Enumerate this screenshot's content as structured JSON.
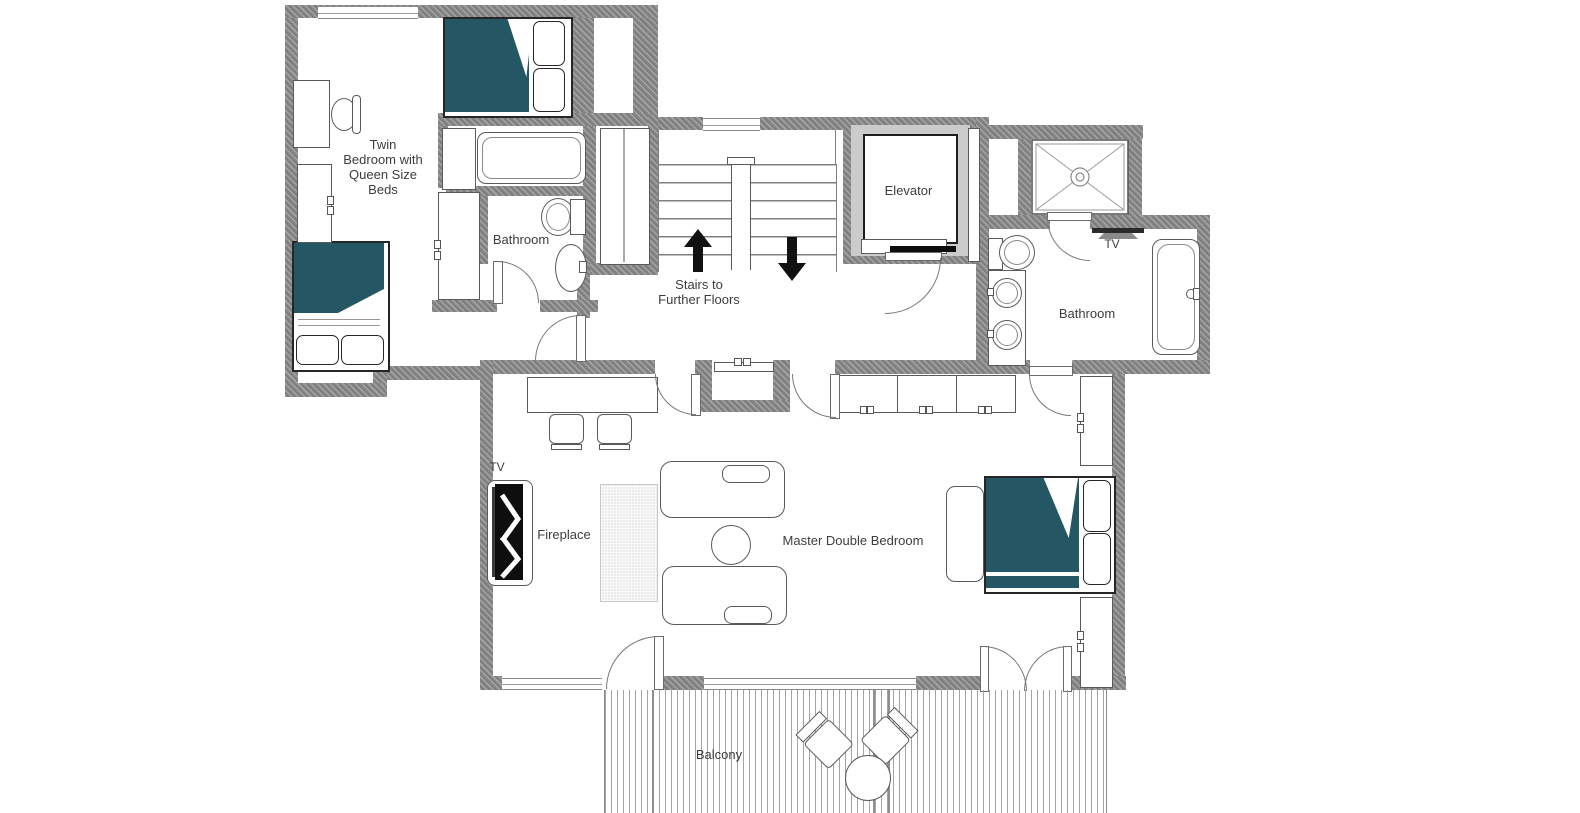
{
  "colors": {
    "wall": "#858585",
    "bed_teal": "#245763",
    "elevator_shaft": "#cbcbcb",
    "outline": "#5a5a5a"
  },
  "rooms": {
    "twin_bedroom": {
      "label_lines": [
        "Twin",
        "Bedroom with",
        "Queen Size",
        "Beds"
      ]
    },
    "bathroom_upper": {
      "label": "Bathroom"
    },
    "stairwell": {
      "label_lines": [
        "Stairs to",
        "Further Floors"
      ]
    },
    "elevator": {
      "label": "Elevator"
    },
    "ensuite_bathroom": {
      "label": "Bathroom",
      "tv_label": "TV"
    },
    "master_bedroom": {
      "label": "Master Double Bedroom",
      "fireplace_label": "Fireplace",
      "tv_label": "TV"
    },
    "balcony": {
      "label": "Balcony"
    }
  }
}
